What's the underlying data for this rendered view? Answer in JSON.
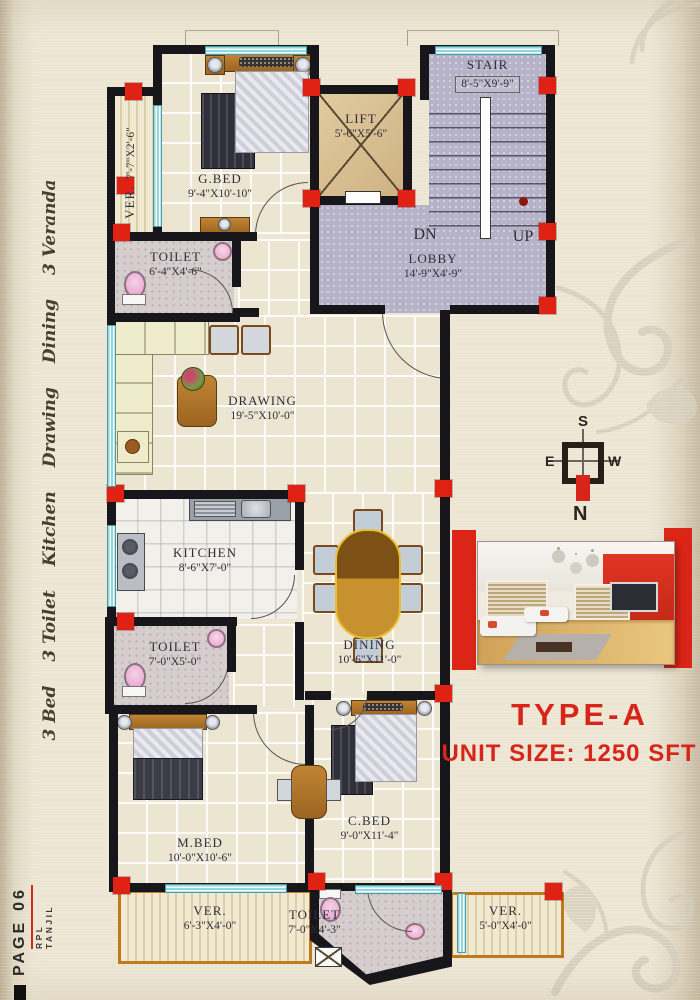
{
  "sidebar": {
    "items": [
      "3 Bed",
      "3 Toilet",
      "Kitchen",
      "Drawing",
      "Dining",
      "3 Veranda"
    ]
  },
  "footer": {
    "page_label": "PAGE",
    "page_number": "06",
    "brand": "RPL TANJIL"
  },
  "plan": {
    "rooms": {
      "ver_tl": {
        "name": "VER.",
        "dims": "7'-7\"X2'-6\""
      },
      "gbed": {
        "name": "G.BED",
        "dims": "9'-4\"X10'-10\""
      },
      "lift": {
        "name": "LIFT",
        "dims": "5'-6\"X5'-6\""
      },
      "stair": {
        "name": "STAIR",
        "dims": "8'-5\"X9'-9\""
      },
      "lobby": {
        "name": "LOBBY",
        "dims": "14'-9\"X4'-9\"",
        "dn": "DN",
        "up": "UP"
      },
      "toilet_t": {
        "name": "TOILET",
        "dims": "6'-4\"X4'-6\""
      },
      "drawing": {
        "name": "DRAWING",
        "dims": "19'-5\"X10'-0\""
      },
      "kitchen": {
        "name": "KITCHEN",
        "dims": "8'-6\"X7'-0\""
      },
      "dining": {
        "name": "DINING",
        "dims": "10'-6\"X11'-0\""
      },
      "toilet_m": {
        "name": "TOILET",
        "dims": "7'-0\"X5'-0\""
      },
      "mbed": {
        "name": "M.BED",
        "dims": "10'-0\"X10'-6\""
      },
      "cbed": {
        "name": "C.BED",
        "dims": "9'-0\"X11'-4\""
      },
      "ver_bl": {
        "name": "VER.",
        "dims": "6'-3\"X4'-0\""
      },
      "toilet_b": {
        "name": "TOILET",
        "dims": "7'-0\"X4'-3\""
      },
      "ver_br": {
        "name": "VER.",
        "dims": "5'-0\"X4'-0\""
      }
    }
  },
  "compass": {
    "n": "N",
    "s": "S",
    "e": "E",
    "w": "W"
  },
  "info": {
    "type_label": "TYPE-A",
    "unit_size": "UNIT SIZE: 1250 SFT"
  }
}
